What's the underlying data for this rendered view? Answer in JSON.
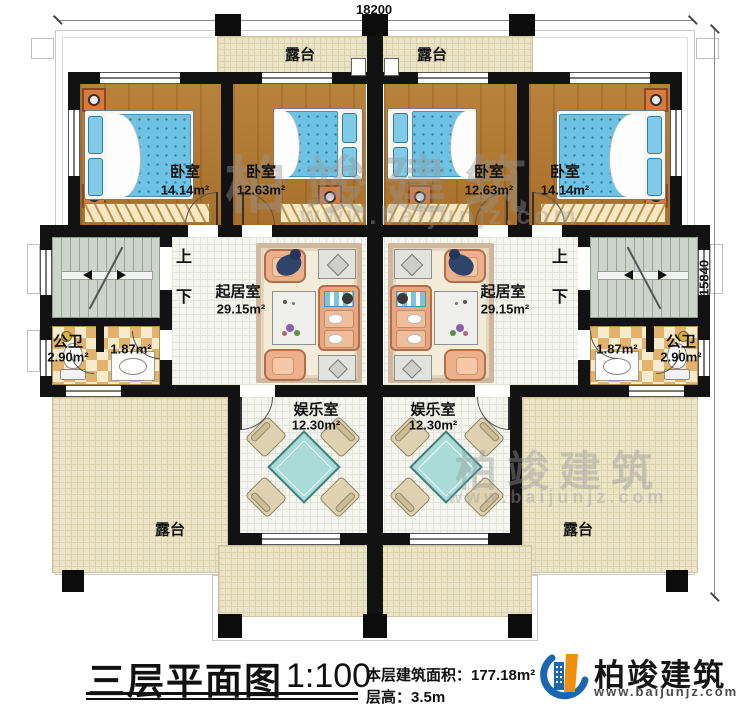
{
  "dimensions": {
    "top": "18200",
    "right": "15840"
  },
  "rooms": {
    "terrace_top_left": {
      "name": "露台"
    },
    "terrace_top_right": {
      "name": "露台"
    },
    "bedroom_outer_left": {
      "name": "卧室",
      "area": "14.14m²"
    },
    "bedroom_inner_left": {
      "name": "卧室",
      "area": "12.63m²"
    },
    "bedroom_inner_right": {
      "name": "卧室",
      "area": "12.63m²"
    },
    "bedroom_outer_right": {
      "name": "卧室",
      "area": "14.14m²"
    },
    "living_left": {
      "name": "起居室",
      "area": "29.15m²"
    },
    "living_right": {
      "name": "起居室",
      "area": "29.15m²"
    },
    "bath_left": {
      "name": "公卫",
      "area": "2.90m²",
      "sub_area": "1.87m²"
    },
    "bath_right": {
      "name": "公卫",
      "area": "2.90m²",
      "sub_area": "1.87m²"
    },
    "ent_left": {
      "name": "娱乐室",
      "area": "12.30m²"
    },
    "ent_right": {
      "name": "娱乐室",
      "area": "12.30m²"
    },
    "terrace_bottom_left": {
      "name": "露台"
    },
    "terrace_bottom_right": {
      "name": "露台"
    }
  },
  "stairs": {
    "up": "上",
    "down": "下"
  },
  "titleblock": {
    "title": "三层平面图",
    "scale": "1:100",
    "area_line": "本层建筑面积：177.18m²",
    "height_line": "层高：3.5m"
  },
  "brand": {
    "name": "柏竣建筑",
    "url": "www.baijunjz.com"
  },
  "watermark": {
    "name": "柏竣建筑",
    "url": "www.baijunjz.com"
  },
  "colors": {
    "wall": "#121212",
    "wood_floor": "#b07a33",
    "bed": "#6ec2e4",
    "terrace": "#ece4c8",
    "stair": "#ccd4cb",
    "sofa": "#e9a682",
    "logo_blue": "#1a67b0",
    "logo_orange": "#f0900f"
  }
}
